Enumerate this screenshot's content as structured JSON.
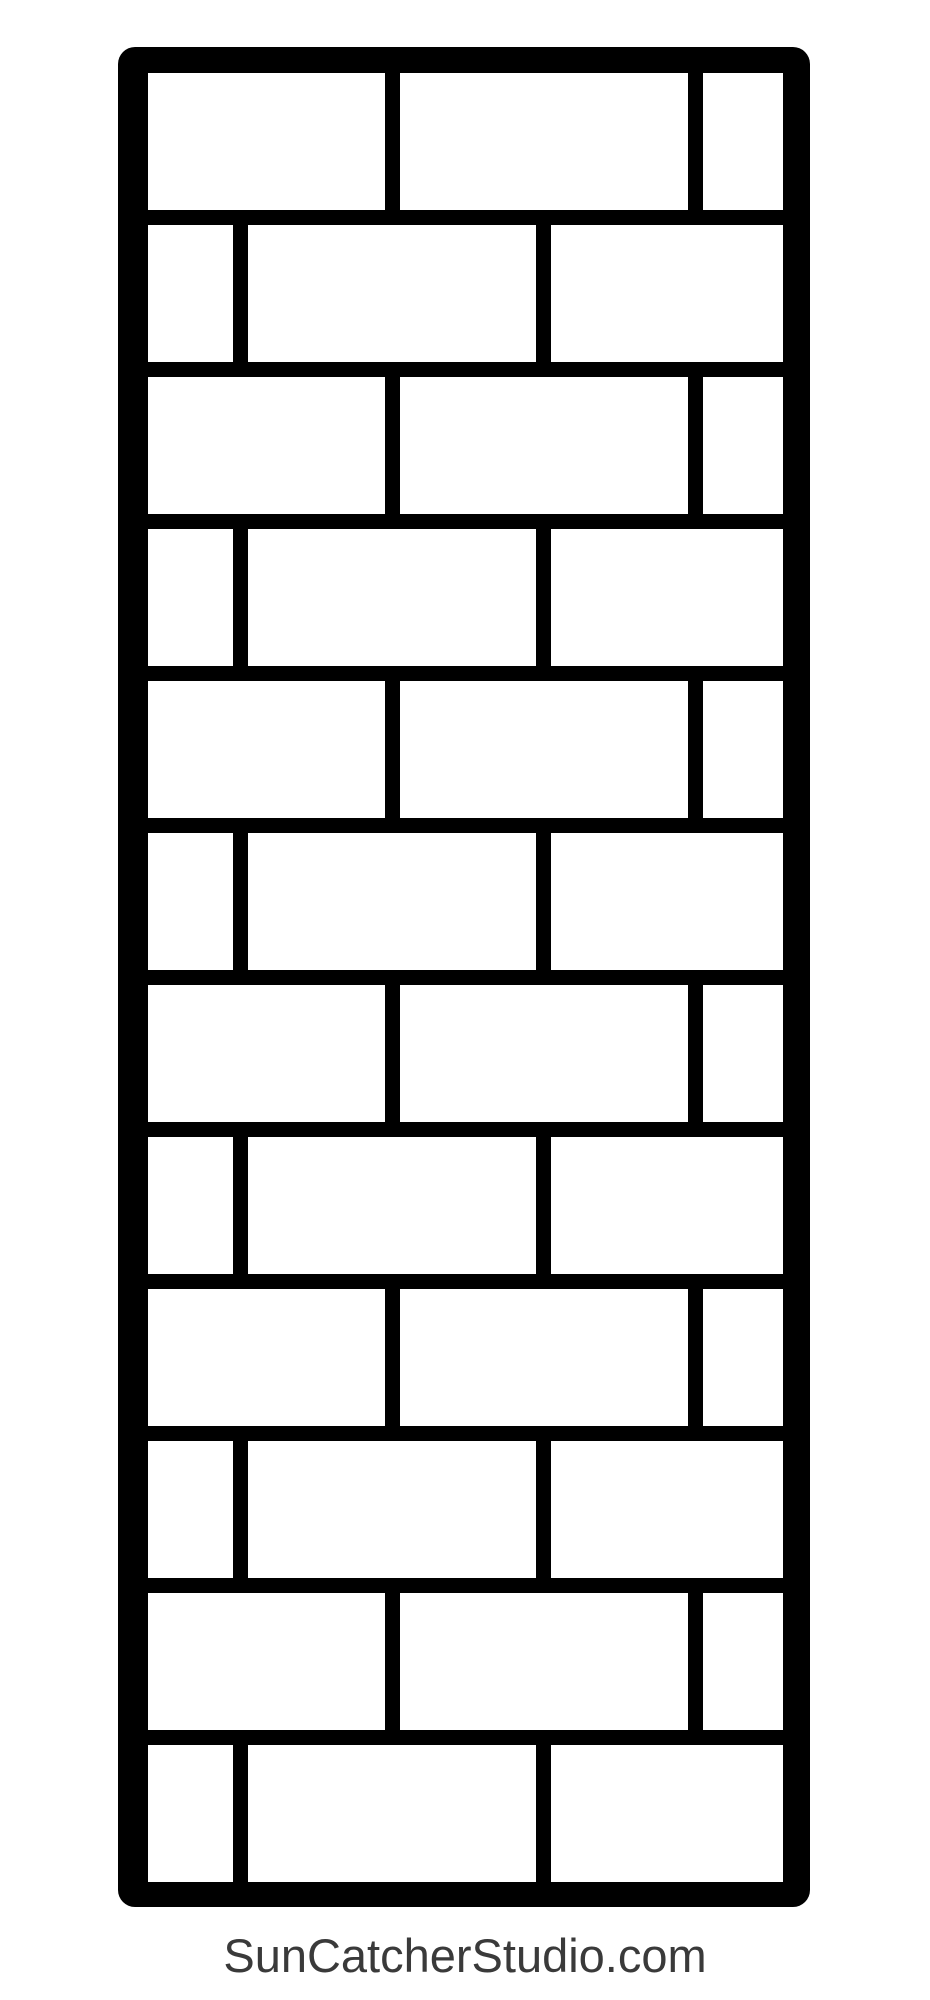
{
  "page": {
    "width": 930,
    "height": 2000,
    "background": "#ffffff"
  },
  "watermark": {
    "text": "SunCatcherStudio.com",
    "color": "#3a3a3a",
    "font_size_px": 47,
    "top_px": 1928
  },
  "pattern": {
    "name": "brick wall stencil pattern",
    "wall": {
      "x": 118,
      "y": 47,
      "width": 692,
      "height": 1860,
      "corner_radius": 17,
      "border_thickness": 27,
      "line_color": "#000000",
      "brick_color": "#ffffff",
      "brick_height": 137,
      "mortar_thickness": 15,
      "row_pitch": 152,
      "num_rows": 12
    },
    "row_types": {
      "A": {
        "bricks": [
          {
            "x": 148,
            "w": 237
          },
          {
            "x": 400,
            "w": 288
          },
          {
            "x": 703,
            "w": 80
          }
        ]
      },
      "B": {
        "bricks": [
          {
            "x": 148,
            "w": 85
          },
          {
            "x": 248,
            "w": 288
          },
          {
            "x": 551,
            "w": 232
          }
        ]
      }
    },
    "rows": [
      {
        "y": 73,
        "type": "A"
      },
      {
        "y": 225,
        "type": "B"
      },
      {
        "y": 377,
        "type": "A"
      },
      {
        "y": 529,
        "type": "B"
      },
      {
        "y": 681,
        "type": "A"
      },
      {
        "y": 833,
        "type": "B"
      },
      {
        "y": 985,
        "type": "A"
      },
      {
        "y": 1137,
        "type": "B"
      },
      {
        "y": 1289,
        "type": "A"
      },
      {
        "y": 1441,
        "type": "B"
      },
      {
        "y": 1593,
        "type": "A"
      },
      {
        "y": 1745,
        "type": "B"
      }
    ]
  }
}
